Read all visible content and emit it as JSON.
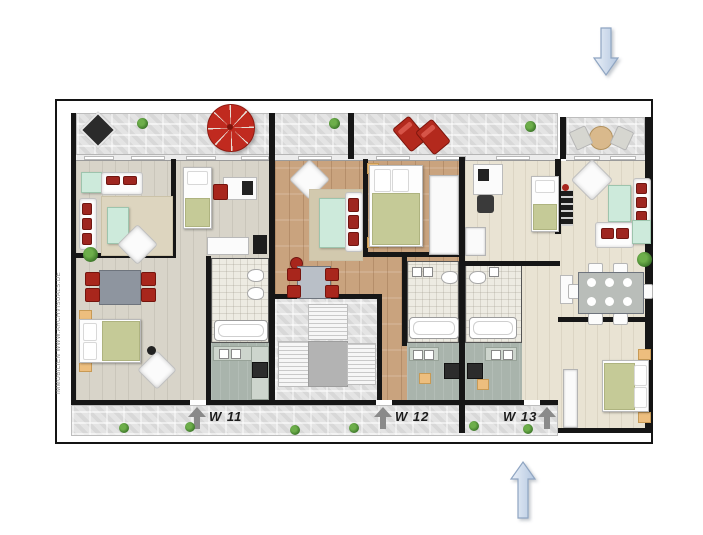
{
  "slide": {
    "background": "#ffffff"
  },
  "floorplan_image": {
    "border_color": "#141414",
    "watermark": "IMMOBILIEN WWW.ARCHVISUALS.DE",
    "unit_labels": [
      {
        "label": "W 11"
      },
      {
        "label": "W 12"
      },
      {
        "label": "W 13"
      }
    ],
    "colors": {
      "wall": "#161616",
      "terrace_stone": "#e4e4e4",
      "walkway_stone": "#e0e0e0",
      "floor_left_unit": "#d8d4c9",
      "floor_middle_unit": "#c9a37e",
      "floor_right_unit": "#e9e3d3",
      "bath_tile": "#edebe2",
      "kitchen_floor": "#a9b4ac",
      "accent_red": "#a8261c",
      "umbrella_red": "#c02a1f",
      "mint_green": "#cdeadb",
      "blanket_green": "#c5ca97",
      "stairs_landing": "#b3b3b3",
      "label_arrow_gray": "#8a8a8a"
    }
  },
  "shapes": {
    "top_right_arrow": {
      "direction": "down",
      "fill_light": "#e9eff8",
      "fill_dark": "#b4c7e0",
      "stroke": "#8fa5c2"
    },
    "bottom_center_arrow": {
      "direction": "up",
      "fill_light": "#e9eff8",
      "fill_dark": "#b4c7e0",
      "stroke": "#8fa5c2"
    }
  }
}
